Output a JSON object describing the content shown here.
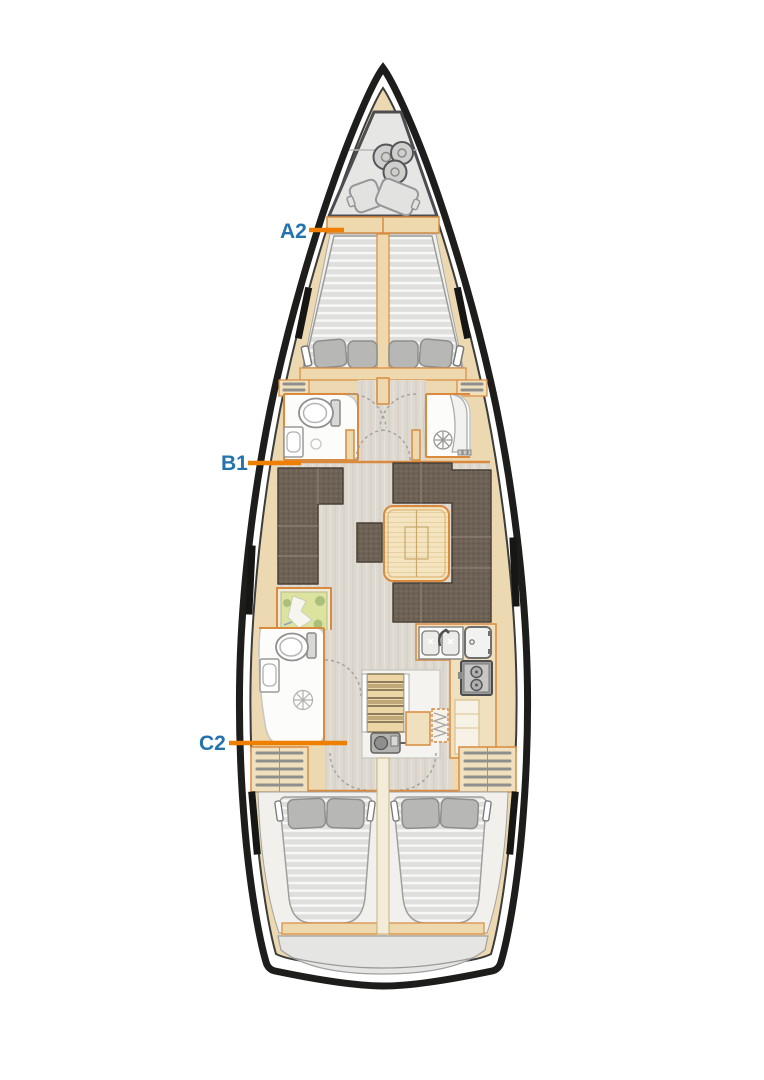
{
  "diagram": {
    "type": "sailing-yacht-deck-layout-plan",
    "orientation": "bow-up",
    "labels": {
      "a2": {
        "text": "A2"
      },
      "b1": {
        "text": "B1"
      },
      "c2": {
        "text": "C2"
      }
    },
    "colors": {
      "background": "#ffffff",
      "label_text": "#2573ae",
      "leader_line": "#ee7f00",
      "hull_outline": "#1d1d1b",
      "deck_wood": "#ecd9b2",
      "wood_trim": "#d98a3f",
      "upholstery_brown": "#6e6356",
      "mattress_gray": "#dededc",
      "floor_gray": "#dfdbd2",
      "locker_gray": "#e6e6e4"
    },
    "areas": {
      "bow_locker": "anchor-and-fender-locker",
      "forward_cabin": "v-berth-double-cabin",
      "forward_head_port": "wc-with-washbasin",
      "forward_head_starboard": "separate-shower-room",
      "saloon_port": "l-shaped-sofa-with-stool",
      "saloon_starboard": "u-shaped-dinette-with-folding-table",
      "nav_station_port": "chart-table",
      "aft_head_port": "wc-shower-washbasin",
      "galley_starboard": "galley-double-sink-fridge-stove",
      "companionway": "stairs-over-engine",
      "aft_cabin_port": "double-berth",
      "aft_cabin_starboard": "double-berth",
      "stern": "transom-lazarette"
    }
  }
}
